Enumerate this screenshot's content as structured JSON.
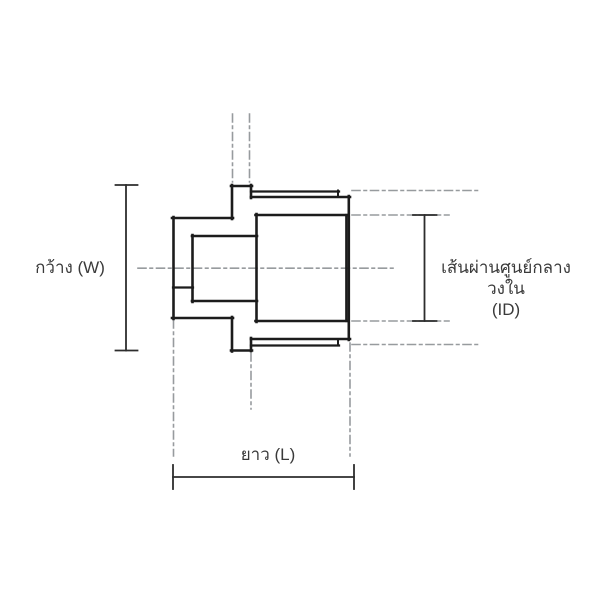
{
  "figure": {
    "type": "engineering-drawing-cross-section",
    "canvas": {
      "width": 600,
      "height": 600,
      "background": "#ffffff"
    },
    "colors": {
      "outline": "#1c1c1c",
      "dimension": "#2d2d2d",
      "centerline": "#979b9e",
      "text": "#3a3a3a"
    },
    "centerline_dash": "8 4 2.5 4",
    "outline_segments": [
      [
        172,
        218,
        233,
        218
      ],
      [
        173.5,
        217,
        173.5,
        319
      ],
      [
        172,
        318,
        233,
        318
      ],
      [
        232,
        185,
        232,
        219
      ],
      [
        231,
        186,
        252,
        186
      ],
      [
        251,
        185,
        251,
        198
      ],
      [
        251,
        191.5,
        339,
        191.5,
        2.3
      ],
      [
        338,
        190.5,
        338,
        197,
        2
      ],
      [
        251,
        197,
        350,
        197
      ],
      [
        348.8,
        196,
        348.8,
        340
      ],
      [
        251,
        339,
        350,
        339
      ],
      [
        338,
        339,
        338,
        345.5,
        2
      ],
      [
        251,
        345.5,
        339,
        345.5,
        2.3
      ],
      [
        251,
        338,
        251,
        351
      ],
      [
        231,
        350.5,
        252,
        350.5
      ],
      [
        232,
        317,
        232,
        351.5
      ],
      [
        192,
        236,
        257,
        236
      ],
      [
        192.5,
        235,
        192.5,
        302
      ],
      [
        192,
        301,
        257,
        301
      ],
      [
        173,
        287.5,
        193,
        287.5,
        2.2
      ],
      [
        256.5,
        214,
        256.5,
        322
      ],
      [
        255.5,
        215,
        347.5,
        215
      ],
      [
        346.3,
        215,
        346.3,
        321,
        2.3
      ],
      [
        255.5,
        321,
        347.5,
        321
      ]
    ],
    "centerline_segments": [
      [
        138,
        268.2,
        397,
        268.2
      ],
      [
        232.5,
        114,
        232.5,
        182
      ],
      [
        249.5,
        114,
        249.5,
        182
      ],
      [
        173.5,
        320,
        173.5,
        456
      ],
      [
        251,
        353,
        251,
        409
      ],
      [
        350,
        343,
        350,
        456
      ],
      [
        352,
        190.5,
        478,
        190.5
      ],
      [
        352,
        215,
        449,
        215
      ],
      [
        352,
        321,
        449,
        321
      ],
      [
        352,
        344.5,
        478,
        344.5
      ]
    ],
    "dimensions": [
      {
        "name": "width",
        "segments": [
          [
            126,
            185,
            126,
            350.5
          ],
          [
            115.5,
            185,
            137.5,
            185
          ],
          [
            115.5,
            350.5,
            137.5,
            350.5
          ]
        ]
      },
      {
        "name": "inner-diameter",
        "segments": [
          [
            424.5,
            215,
            424.5,
            321
          ],
          [
            413,
            215,
            436.5,
            215
          ],
          [
            413,
            321,
            436.5,
            321
          ]
        ]
      },
      {
        "name": "length",
        "segments": [
          [
            173,
            477,
            354,
            477
          ],
          [
            173,
            465,
            173,
            489
          ],
          [
            354,
            465,
            354,
            489
          ]
        ]
      }
    ],
    "labels": {
      "width": "กว้าง (W)",
      "inner_diameter_line1": "เส้นผ่านศูนย์กลางวงใน",
      "inner_diameter_line2": "(ID)",
      "length": "ยาว (L)"
    }
  }
}
